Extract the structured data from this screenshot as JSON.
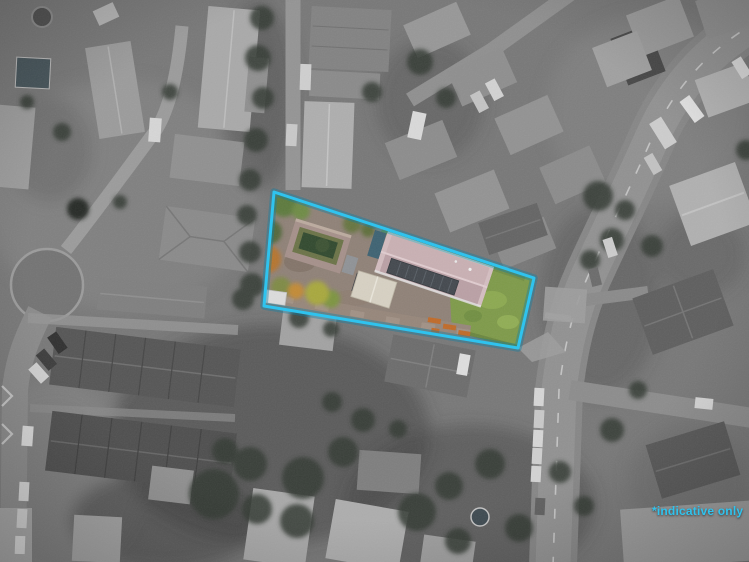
{
  "annotation": {
    "text": "*indicative only"
  },
  "colors": {
    "boundary_accent": "#2fc3ee",
    "annotation_text": "#2fc3ee",
    "highlight_roof": "#c9b0b3",
    "solar_panels": "#43484e",
    "highlight_lawn": "#7e9a49",
    "grass_strip": "#6f8c44",
    "courtyard_walls": "#a5908a",
    "pond": "#31492e",
    "autumn_tree": "#b5742f",
    "shed_roof": "#d7d1c3",
    "teal_vehicle": "#3d6272",
    "orange_fence": "#c06a28"
  }
}
